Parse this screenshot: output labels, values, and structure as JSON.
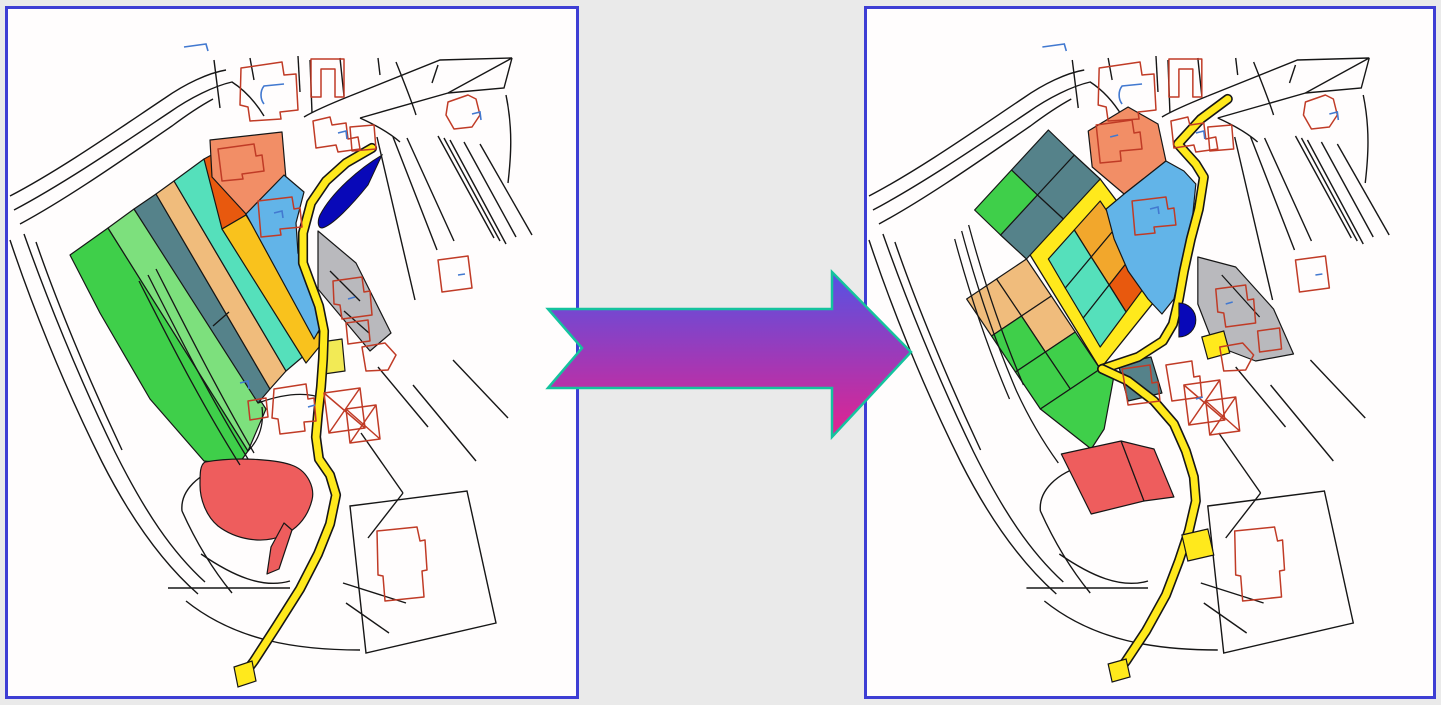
{
  "figure": {
    "kind": "land-readjustment-before-after-maps"
  },
  "palette": {
    "green": "#3fcf4a",
    "green2": "#7de07d",
    "slate": "#55828a",
    "sandy": "#f0bc7c",
    "turquoise": "#55e0bb",
    "vermillion": "#e8590e",
    "gold": "#f9c21d",
    "gold2": "#f2a72c",
    "salmon": "#f28e66",
    "skyblue": "#62b4e8",
    "navy": "#0808b8",
    "gray": "#b9b9bd",
    "red": "#ee5d5d",
    "road": "#ffe91c",
    "paleyellow": "#f2ea55",
    "line": "#161616",
    "building": "#c03b26",
    "blue": "#4279d0",
    "panel_border": "#3e3ed4",
    "page_bg": "#eaeaea",
    "map_bg": "#fffdfd"
  },
  "arrow": {
    "points": "10,47 294,47 294,10 373,90 294,175 294,126 10,126 44,86",
    "gradient_top": "#5552e4",
    "gradient_bottom": "#e2238f",
    "outline": "#14c39e"
  },
  "base": {
    "lines": [
      "M2,187 C52,161 112,119 157,89 C177,75 200,64 218,61",
      "M6,201 C57,174 117,133 162,103 C182,89 206,77 224,73 C238,82 248,94 256,107",
      "M12,215 C62,188 120,147 164,117 C180,105 194,96 205,90",
      "M2,231 C22,291 54,373 94,453 C124,512 157,556 190,585",
      "M16,225 C38,287 70,367 107,443 C137,503 164,543 197,573",
      "M28,233 C48,291 80,369 114,441",
      "M206,51 L212,99",
      "M242,49 L246,71",
      "M290,47 L292,83",
      "M302,51 L304,104",
      "M332,49 L336,87",
      "M342,87 L432,51 L504,49 L440,84 L352,109",
      "M504,49 L496,79 L440,84",
      "M424,74 L430,56",
      "M342,87 C322,95 306,102 296,108",
      "M352,109 C372,118 384,126 392,133",
      "M369,128 L407,291",
      "M385,128 L429,241",
      "M399,129 L446,232",
      "M430,127 L486,229",
      "M436,129 L492,232",
      "M442,131 L498,235",
      "M456,133 L508,228",
      "M472,135 L524,226",
      "M498,86 C505,120 503,148 500,174",
      "M370,49 L372,66",
      "M388,53 C396,73 404,93 408,106",
      "M160,579 L282,579",
      "M193,545 C225,567 255,580 282,572",
      "M178,592 C228,632 290,641 352,641",
      "M335,574 L398,594",
      "M338,594 L381,624",
      "M342,497 L459,482 L488,614 L358,644 Z",
      "M353,424 L395,484",
      "M395,484 L360,529",
      "M370,358 L420,418",
      "M405,376 L468,452",
      "M445,351 L500,409",
      "M219,456 C190,464 172,482 174,502",
      "M174,502 C192,542 210,567 224,584"
    ],
    "buildings": [
      "M233,59 L274,53 L276,66 L288,65 L290,101 L272,103 L273,110 L242,112 L240,98 L232,96 Z",
      "M303,50 L336,50 L336,88 L327,88 L327,60 L313,60 L313,88 L303,88 Z",
      "M305,112 L322,108 L324,116 L338,114 L340,130 L350,128 L352,140 L330,143 L328,136 L308,139 Z",
      "M342,118 L366,116 L368,140 L344,142 Z",
      "M440,93 L460,86 L468,90 L472,106 L464,118 L446,120 L438,106 Z",
      "M430,251 L460,247 L464,279 L434,283 Z",
      "M369,522 L409,518 L412,532 L417,531 L419,561 L414,562 L416,588 L377,592 L375,567 L370,566 Z",
      "M354,338 L377,334 L388,346 L380,361 L358,362 Z"
    ],
    "blue_marks": [
      "M176,38 L198,35 L200,42",
      "M256,95 C252,90 252,82 256,77 L276,75",
      "M330,124 L338,122 L339,130",
      "M464,105 L472,103 L473,111",
      "M450,266 L457,265"
    ]
  },
  "before_map": {
    "parcels": [
      {
        "name": "strip-green-west",
        "fill": "green",
        "pts": "62,246 100,219 240,442 230,456 196,452 142,390 92,304"
      },
      {
        "name": "strip-green-east",
        "fill": "green2",
        "pts": "100,219 126,200 258,400 240,442"
      },
      {
        "name": "strip-slate",
        "fill": "slate",
        "pts": "126,200 148,185 262,380 250,394"
      },
      {
        "name": "strip-sandy",
        "fill": "sandy",
        "pts": "148,185 166,172 278,362 262,380"
      },
      {
        "name": "strip-turquoise",
        "fill": "turquoise",
        "pts": "166,172 196,150 298,345 278,362"
      },
      {
        "name": "strip-vermillion",
        "fill": "vermillion",
        "pts": "196,150 220,137 238,206 214,220"
      },
      {
        "name": "strip-gold",
        "fill": "gold",
        "pts": "214,220 238,206 316,332 298,354"
      },
      {
        "name": "parcel-salmon",
        "fill": "salmon",
        "pts": "202,131 274,123 278,170 238,205 204,168"
      },
      {
        "name": "parcel-skyblue",
        "fill": "skyblue",
        "pts": "238,205 276,166 296,183 288,214 290,244 299,263 309,290 314,316 306,330"
      },
      {
        "name": "parcel-gray",
        "fill": "gray",
        "pts": "310,222 348,254 383,324 362,342 310,280"
      },
      {
        "name": "parcel-red-blob",
        "fill": "red",
        "d": "M197,453 C232,447 272,451 286,457 C300,463 307,479 304,491 C300,507 290,519 276,526 C254,536 227,530 210,517 C198,507 192,490 192,476 C192,464 192,456 197,453 Z"
      },
      {
        "name": "parcel-red-tail",
        "fill": "red",
        "pts": "276,514 284,521 271,560 259,565 263,538"
      },
      {
        "name": "parcel-yellow-square",
        "fill": "paleyellow",
        "pts": "313,333 334,330 337,362 316,365"
      }
    ],
    "lines": [
      "M140,266 C165,315 200,385 240,450",
      "M148,260 C173,309 208,379 246,444",
      "M131,272 C156,321 191,391 232,456",
      "M205,317 L221,303",
      "M322,262 L352,292",
      "M336,302 L361,324",
      "M250,394 C275,385 298,382 316,390",
      "M240,442 C252,430 256,414 254,398"
    ],
    "roads": [
      {
        "name": "winding-road",
        "w": 7,
        "pts": "364,139 338,154 318,172 303,194 295,224 295,254 302,273 311,297 316,322 315,350 313,378 310,405 308,428 311,450 322,466 328,486 322,515 310,545 292,580 268,618 246,652 234,668"
      }
    ],
    "patches": [
      {
        "name": "road-tip",
        "fill": "road",
        "pts": "226,658 244,652 248,672 230,678"
      }
    ],
    "ponds": [
      "M374,146 C352,159 324,183 312,206 C309,213 310,219 314,219 C324,217 344,196 360,176 Z"
    ],
    "buildings": [
      "M210,140 L246,135 L248,147 L254,146 L256,162 L234,165 L235,170 L214,172 Z",
      "M250,192 L284,188 L286,200 L292,199 L294,218 L272,220 L273,226 L253,228 Z",
      "M325,272 L354,268 L356,283 L362,282 L364,306 L334,310 L332,296 L326,295 Z",
      "M338,314 L360,311 L362,332 L340,335 Z",
      "M240,392 L258,389 L260,408 L242,411 Z",
      "M266,380 L298,375 L300,390 L306,389 L308,412 L296,413 L297,422 L272,425 L270,410 L264,409 Z",
      "M316,384 L352,379 L357,419 L321,424 Z M316,384 L357,419 M352,379 L321,424",
      "M338,400 L368,396 L372,430 L342,434 Z M338,400 L372,430 M368,396 L342,434"
    ],
    "blue_marks": [
      "M266,204 L274,202 L275,209",
      "M340,290 L347,288",
      "M232,374 L240,372 L241,380",
      "M300,398 L307,396"
    ]
  },
  "after_map": {
    "underlays": [
      {
        "name": "ring-road",
        "fill": "road",
        "pts": "234,170 308,268 234,360 160,240"
      }
    ],
    "parcels": [
      {
        "name": "cell-gold-1",
        "fill": "gold2",
        "pts": "234,192 251,217 225,248 208,221"
      },
      {
        "name": "cell-gold-2",
        "fill": "gold2",
        "pts": "251,217 269,243 243,276 225,248"
      },
      {
        "name": "cell-vermillion",
        "fill": "vermillion",
        "pts": "269,243 286,268 260,303 243,276"
      },
      {
        "name": "cell-cyan-1",
        "fill": "turquoise",
        "pts": "208,221 225,248 199,279 182,250"
      },
      {
        "name": "cell-cyan-2",
        "fill": "turquoise",
        "pts": "225,248 243,276 217,309 199,279"
      },
      {
        "name": "cell-cyan-3",
        "fill": "turquoise",
        "pts": "243,276 260,303 234,338 217,309"
      },
      {
        "name": "cell-slate-a",
        "fill": "slate",
        "pts": "234,170 197,210 171,186 208,146"
      },
      {
        "name": "cell-slate-b",
        "fill": "slate",
        "pts": "197,210 160,250 134,226 171,186"
      },
      {
        "name": "cell-slate-c",
        "fill": "slate",
        "pts": "208,146 171,186 145,161 182,121"
      },
      {
        "name": "cell-green-a",
        "fill": "green",
        "pts": "171,186 134,226 108,201 145,161"
      },
      {
        "name": "cell-sandy-1",
        "fill": "sandy",
        "pts": "160,250 185,287 155,307 130,270"
      },
      {
        "name": "cell-sandy-2",
        "fill": "sandy",
        "pts": "185,287 209,323 179,343 155,307"
      },
      {
        "name": "cell-sandy-3",
        "fill": "sandy",
        "pts": "130,270 155,307 125,327 100,290"
      },
      {
        "name": "cell-green-b",
        "fill": "green",
        "pts": "209,323 234,360 204,380 179,343"
      },
      {
        "name": "cell-green-c",
        "fill": "green",
        "pts": "155,307 179,343 149,363 125,327"
      },
      {
        "name": "cell-green-d",
        "fill": "green",
        "pts": "179,343 204,380 174,400 149,363"
      },
      {
        "name": "cell-green-south",
        "fill": "green",
        "pts": "204,380 234,360 248,366 238,420 225,440 174,400"
      },
      {
        "name": "cell-red-1",
        "fill": "red",
        "pts": "195,445 255,432 278,492 225,505"
      },
      {
        "name": "cell-red-2",
        "fill": "red",
        "pts": "255,432 288,440 308,488 278,492"
      },
      {
        "name": "cell-slate-house",
        "fill": "slate",
        "pts": "252,355 285,348 296,384 262,392"
      },
      {
        "name": "parcel-salmon",
        "fill": "salmon",
        "pts": "222,122 262,98 292,115 300,152 258,185 226,158"
      },
      {
        "name": "parcel-skyblue",
        "fill": "skyblue",
        "pts": "258,185 300,152 318,162 330,175 327,205 319,240 313,268 308,290 296,305 282,290 262,262 248,230 240,200"
      },
      {
        "name": "parcel-gray",
        "fill": "gray",
        "pts": "332,248 370,258 408,300 428,345 390,352 348,336 332,295"
      }
    ],
    "lines": [
      "M95,222 C108,270 126,326 150,382 C162,408 176,432 192,454",
      "M88,230 C101,278 119,334 143,390",
      "M102,216 C115,264 133,320 157,376",
      "M356,266 L394,308"
    ],
    "roads": [
      {
        "name": "main-road-north",
        "w": 7,
        "pts": "362,90 335,110 312,135 330,155 338,168 333,200 325,230 318,262 313,290 307,315 297,332 272,348 248,356 236,360"
      },
      {
        "name": "main-road-south",
        "w": 7,
        "pts": "236,360 262,372 288,392 308,415 320,442 328,468 330,492 323,522 313,552 300,586 280,622 260,652 250,665"
      }
    ],
    "patches": [
      {
        "name": "road-widening",
        "fill": "road",
        "pts": "316,526 342,520 348,546 322,552"
      },
      {
        "name": "road-tip",
        "fill": "road",
        "pts": "242,655 260,650 264,668 246,673"
      },
      {
        "name": "yellow-square",
        "fill": "road",
        "pts": "336,328 358,322 364,344 342,350"
      }
    ],
    "ponds": [
      "M313,294 A16,16 0 0 1 313,328 Z"
    ],
    "buildings": [
      "M230,116 L266,111 L268,124 L274,123 L276,140 L254,142 L255,152 L234,154 Z",
      "M266,192 L300,188 L302,200 L308,199 L310,216 L288,218 L289,224 L269,226 Z",
      "M350,280 L380,276 L382,291 L388,290 L390,314 L360,318 L358,304 L352,303 Z",
      "M392,322 L414,319 L416,340 L394,343 Z",
      "M256,360 L284,356 L286,374 L292,373 L294,392 L262,396 Z",
      "M300,356 L326,352 L328,368 L334,367 L336,388 L306,392 Z",
      "M318,376 L354,371 L359,411 L323,416 Z M318,376 L359,411 M354,371 L323,416",
      "M340,392 L370,388 L374,422 L344,426 Z M340,392 L374,422 M370,388 L344,426"
    ],
    "blue_marks": [
      "M244,128 L252,126",
      "M284,200 L292,198 L293,205",
      "M360,295 L367,293",
      "M330,390 L337,388"
    ]
  }
}
